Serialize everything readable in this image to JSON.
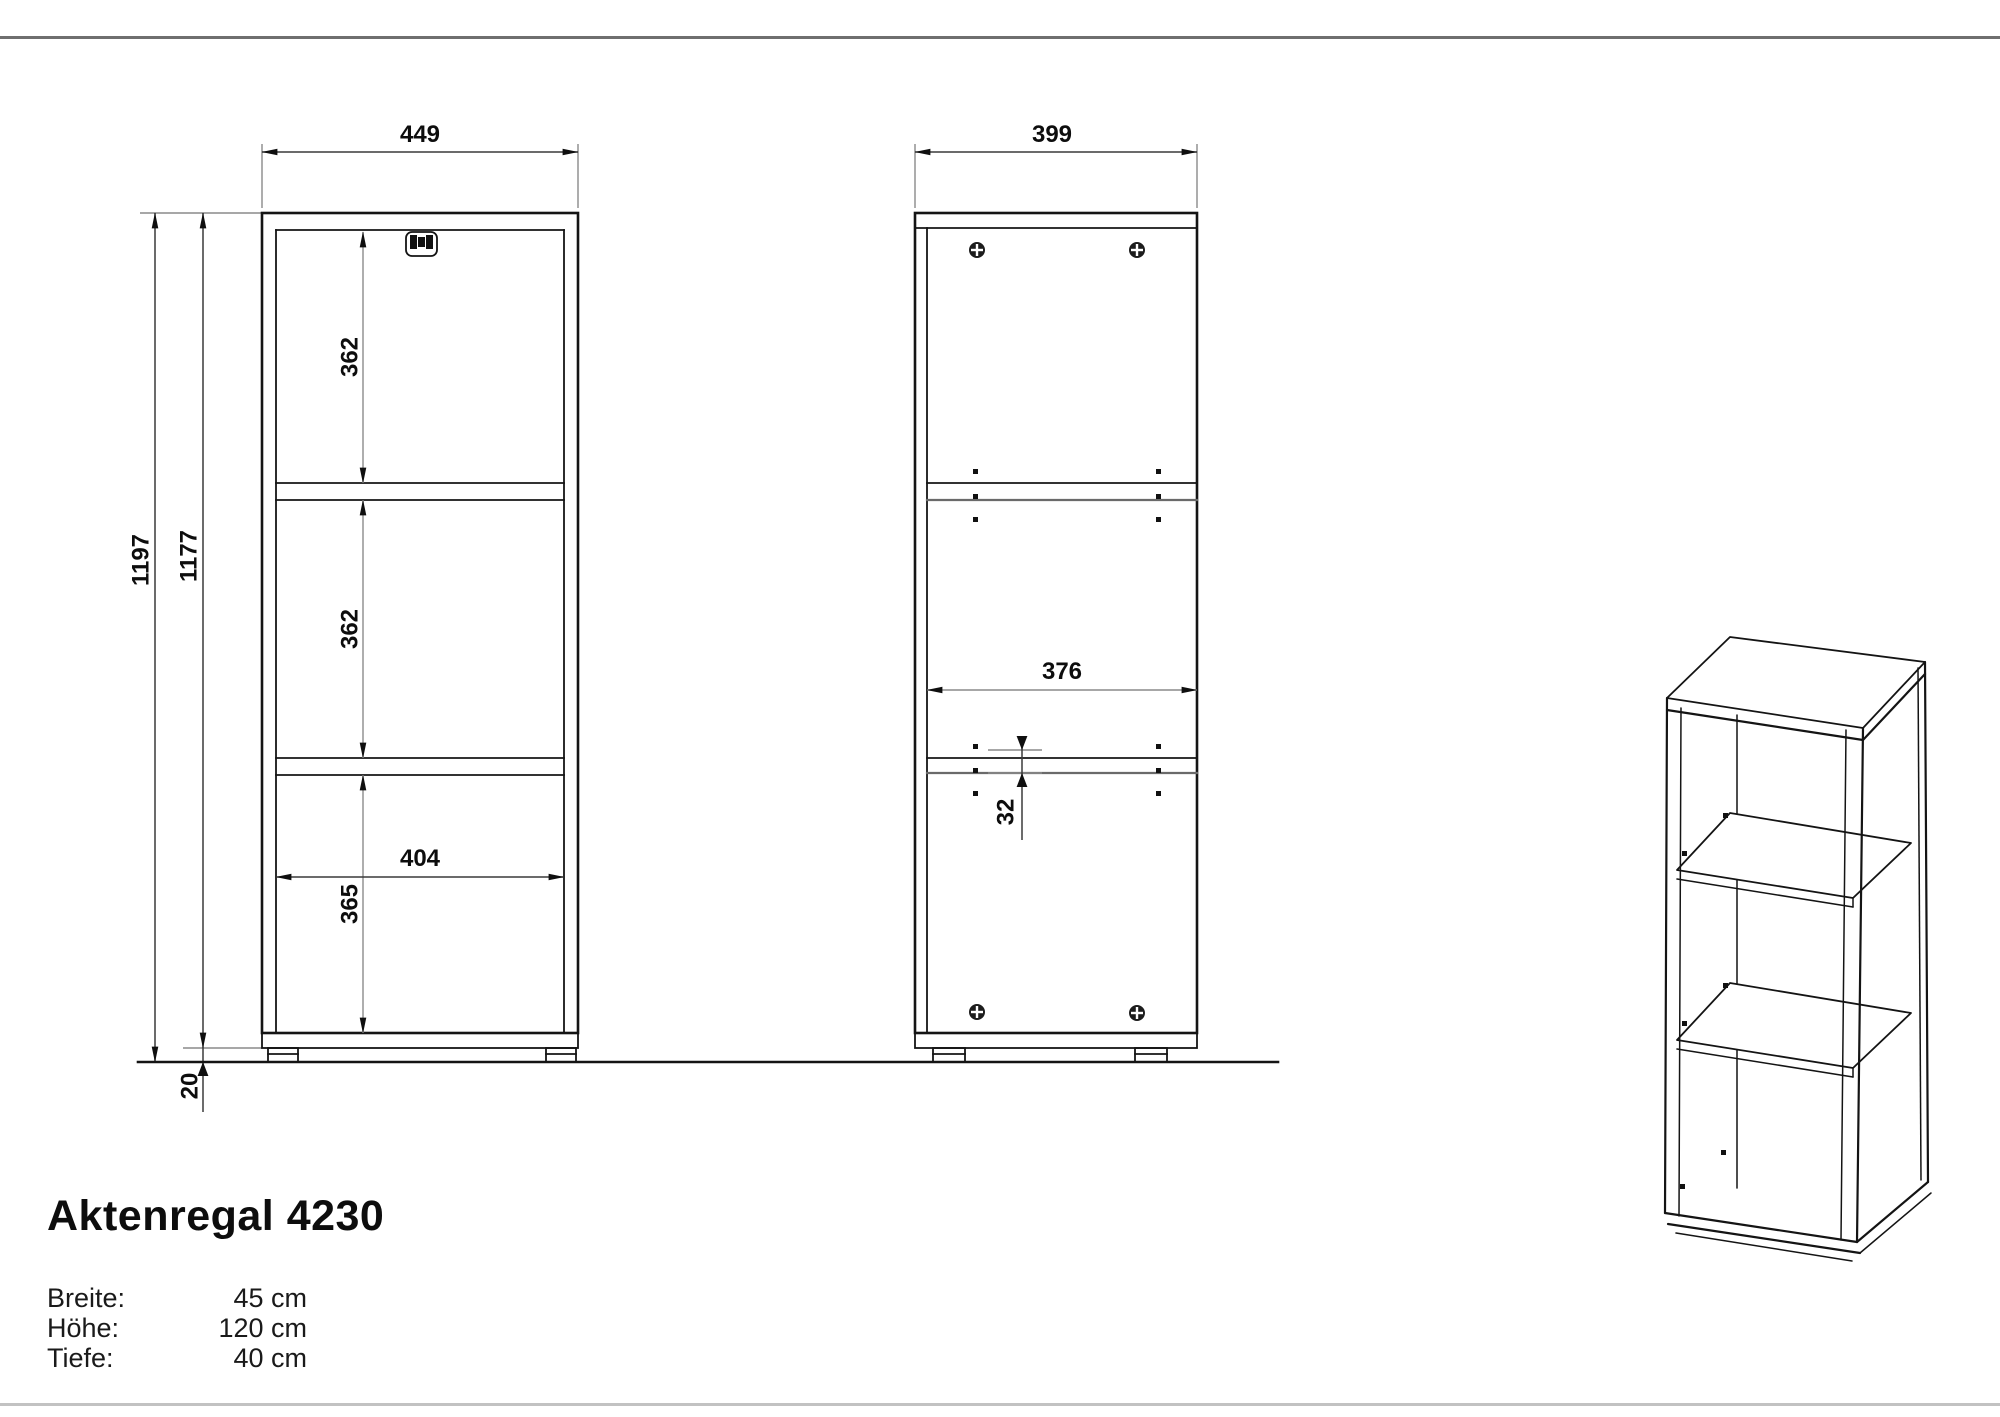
{
  "title": "Aktenregal 4230",
  "specs": [
    {
      "label": "Breite:",
      "value": "45 cm"
    },
    {
      "label": "Höhe:",
      "value": "120 cm"
    },
    {
      "label": "Tiefe:",
      "value": "40 cm"
    }
  ],
  "front_view": {
    "width": "449",
    "total_height": "1197",
    "body_height": "1177",
    "section_top": "362",
    "section_middle": "362",
    "section_bottom": "365",
    "inner_width": "404",
    "foot_height": "20"
  },
  "side_view": {
    "depth": "399",
    "inner_depth": "376",
    "hole_pitch": "32"
  },
  "colors": {
    "line": "#141414",
    "dimension": "#3a3a3a",
    "extension": "#8a8a8a",
    "rule_top": "#6f6f6f",
    "rule_bottom": "#c2c2c2"
  }
}
